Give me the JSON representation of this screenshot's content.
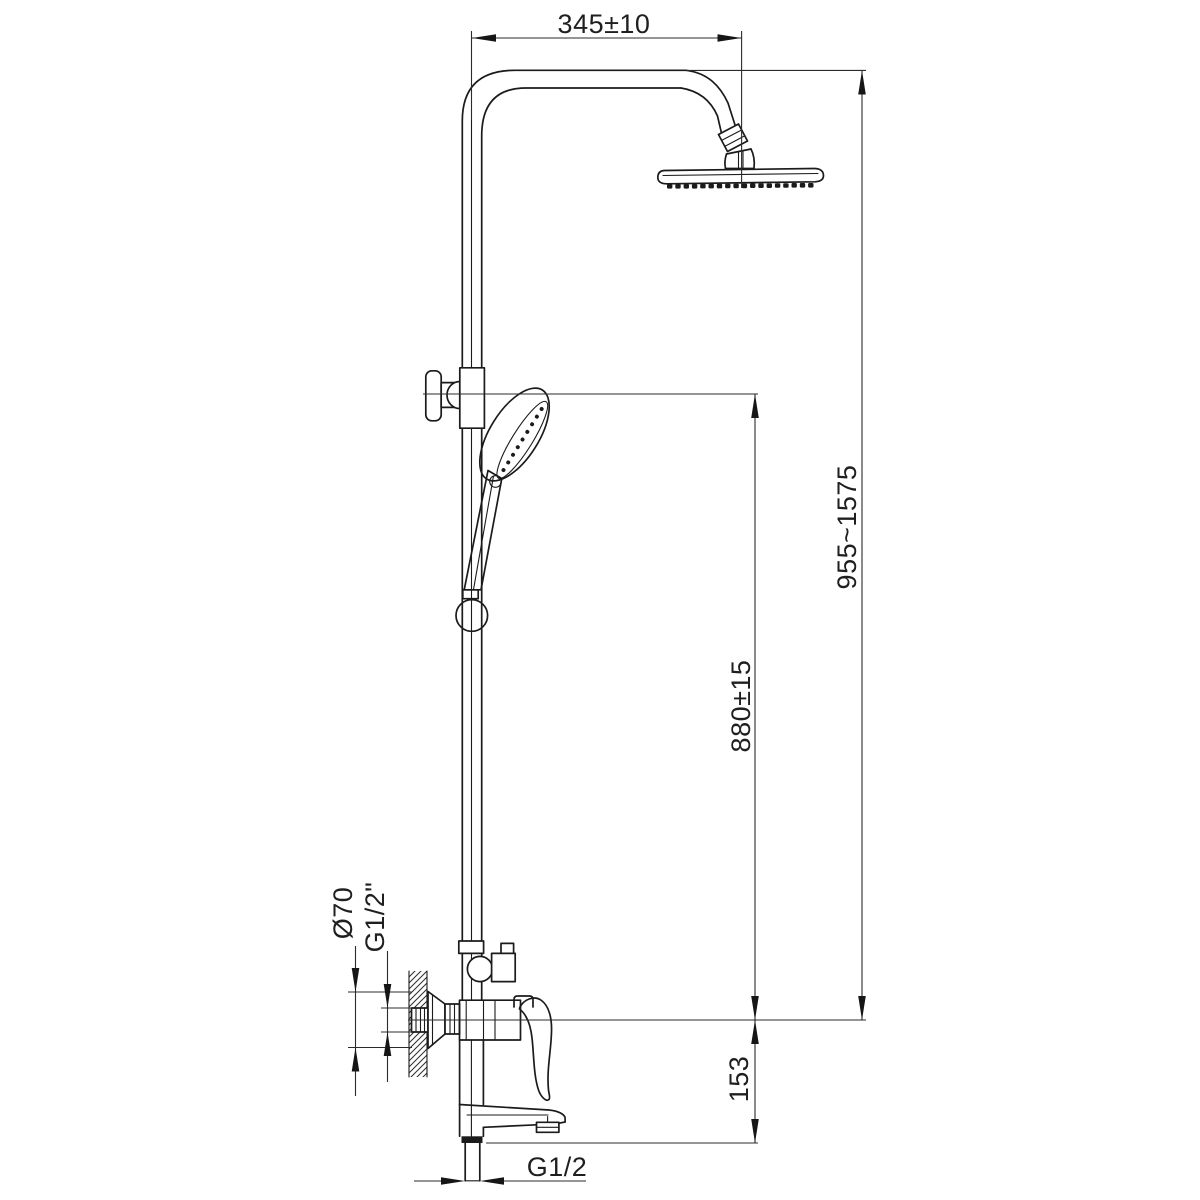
{
  "drawing": {
    "title": "shower-column-technical-drawing",
    "background_color": "#ffffff",
    "line_color": "#1b1b1b",
    "dims": {
      "top_width": "345±10",
      "total_height": "955~1575",
      "bar_height": "880±15",
      "spout_drop": "153",
      "escutcheon_diameter": "Ø70",
      "wall_thread": "G1/2\"",
      "bottom_thread": "G1/2"
    }
  }
}
